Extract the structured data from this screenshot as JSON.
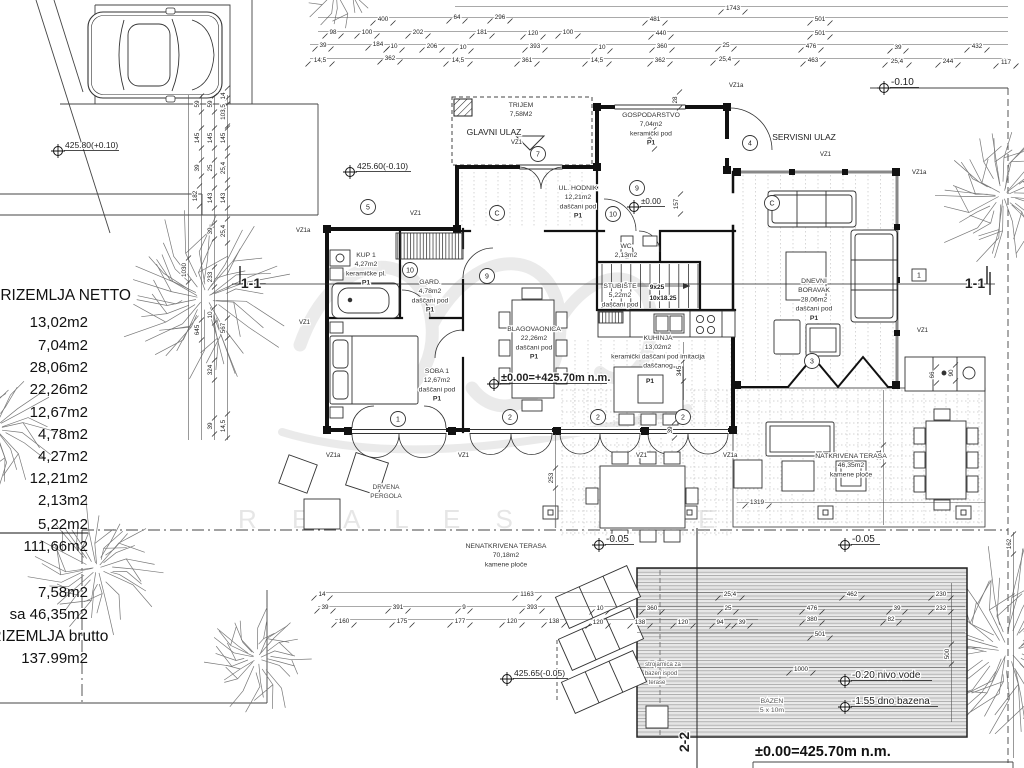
{
  "plan": {
    "watermark_text": "R E A L   E S T A T E",
    "datum_note": "±0.00=425.70m n.m.",
    "area_table": {
      "title": "PRIZEMLJA NETTO",
      "items": [
        "13,02m2",
        "7,04m2",
        "28,06m2",
        "22,26m2",
        "12,67m2",
        "4,78m2",
        "4,27m2",
        "12,21m2",
        "2,13m2",
        "5,22m2",
        "111,66m2"
      ],
      "extra_items": [
        "7,58m2",
        "sa  46,35m2"
      ],
      "total_label": "PRIZEMLJA brutto",
      "total_value": "137.99m2"
    },
    "rooms": [
      {
        "n": "trijem",
        "x": 521,
        "y": 107,
        "lines": [
          "TRIJEM",
          "7,58M2"
        ]
      },
      {
        "n": "gospodarstvo",
        "x": 651,
        "y": 117,
        "lines": [
          "GOSPODARSTVO",
          "7,04m2",
          "keramički pod",
          "P1"
        ]
      },
      {
        "n": "ul-hodnik",
        "x": 578,
        "y": 190,
        "lines": [
          "UL. HODNIK",
          "12,21m2",
          "daščani pod",
          "P1"
        ]
      },
      {
        "n": "kup-1",
        "x": 366,
        "y": 257,
        "lines": [
          "KUP 1",
          "4,27m2",
          "keramičke pl.",
          "P1"
        ]
      },
      {
        "n": "gard",
        "x": 430,
        "y": 284,
        "lines": [
          "GARD.",
          "4,78m2",
          "daščani pod",
          "P1"
        ]
      },
      {
        "n": "wc",
        "x": 626,
        "y": 248,
        "lines": [
          "WC",
          "2,13m2"
        ]
      },
      {
        "n": "stubiste",
        "x": 620,
        "y": 288,
        "lines": [
          "STUBIŠTE",
          "5,22m2",
          "daščani pod"
        ]
      },
      {
        "n": "soba-1",
        "x": 437,
        "y": 373,
        "lines": [
          "SOBA 1",
          "12,67m2",
          "daščani pod",
          "P1"
        ]
      },
      {
        "n": "blagovaonica",
        "x": 534,
        "y": 331,
        "lines": [
          "BLAGOVAONICA",
          "22,26m2",
          "daščani pod",
          "P1"
        ]
      },
      {
        "n": "kuhinja",
        "x": 658,
        "y": 340,
        "lines": [
          "KUHINJA",
          "13,02m2",
          "keramički daščani pod  imitacija",
          "daščanog"
        ]
      },
      {
        "n": "dnevni-boravak",
        "x": 814,
        "y": 283,
        "lines": [
          "DNEVNI",
          "BORAVAK",
          "28,06m2",
          "daščani pod",
          "P1"
        ]
      },
      {
        "n": "natkrivena-terasa",
        "x": 851,
        "y": 458,
        "lines": [
          "NATKRIVENA TERASA",
          "46,35m2",
          "kamene ploče"
        ]
      },
      {
        "n": "nenatkrivena-terasa",
        "x": 506,
        "y": 548,
        "lines": [
          "NENATKRIVENA TERASA",
          "70,18m2",
          "kamene ploče"
        ]
      },
      {
        "n": "bazen",
        "x": 772,
        "y": 703,
        "lines": [
          "BAZEN",
          "5 x 10m"
        ],
        "c": "#555"
      }
    ],
    "labels": [
      {
        "t": "GLAVNI ULAZ",
        "x": 494,
        "y": 135,
        "s": 8.5
      },
      {
        "t": "SERVISNI ULAZ",
        "x": 804,
        "y": 140,
        "s": 8.5
      },
      {
        "t": "DRVENA",
        "x": 386,
        "y": 489,
        "s": 6.5,
        "c": "#444"
      },
      {
        "t": "PERGOLA",
        "x": 386,
        "y": 498,
        "s": 6.5,
        "c": "#444"
      },
      {
        "t": "strojarnica za",
        "x": 663,
        "y": 666,
        "s": 6,
        "c": "#555"
      },
      {
        "t": "bazen ispod",
        "x": 661,
        "y": 675,
        "s": 6,
        "c": "#555"
      },
      {
        "t": "terase",
        "x": 657,
        "y": 684,
        "s": 6,
        "c": "#555"
      },
      {
        "t": "9x25",
        "x": 657,
        "y": 289,
        "s": 6.5,
        "b": true
      },
      {
        "t": "10x18.25",
        "x": 663,
        "y": 300,
        "s": 6.5,
        "b": true
      },
      {
        "t": "P1",
        "x": 650,
        "y": 383,
        "s": 6.5,
        "b": true
      }
    ],
    "vz_labels": [
      {
        "t": "VZ1",
        "x": 410,
        "y": 215
      },
      {
        "t": "VZ1a",
        "x": 296,
        "y": 232
      },
      {
        "t": "VZ1",
        "x": 299,
        "y": 324
      },
      {
        "t": "VZ1",
        "x": 511,
        "y": 144
      },
      {
        "t": "VZ1a",
        "x": 729,
        "y": 87
      },
      {
        "t": "VZ1",
        "x": 820,
        "y": 156
      },
      {
        "t": "VZ1a",
        "x": 912,
        "y": 174
      },
      {
        "t": "VZ1",
        "x": 917,
        "y": 332
      },
      {
        "t": "VZ1a",
        "x": 326,
        "y": 457
      },
      {
        "t": "VZ1",
        "x": 458,
        "y": 457
      },
      {
        "t": "VZ1",
        "x": 636,
        "y": 457
      },
      {
        "t": "VZ1a",
        "x": 723,
        "y": 457
      }
    ],
    "sections": [
      {
        "t": "1-1",
        "x": 251,
        "y": 288,
        "s": 14
      },
      {
        "t": "1-1",
        "x": 975,
        "y": 288,
        "s": 14
      },
      {
        "t": "2-2",
        "x": 689,
        "y": 742,
        "s": 14,
        "rot": -90
      }
    ],
    "markers_circled": [
      [
        "5",
        368,
        207
      ],
      [
        "7",
        538,
        154
      ],
      [
        "4",
        750,
        143
      ],
      [
        "C",
        497,
        213
      ],
      [
        "C",
        772,
        203
      ],
      [
        "10",
        410,
        270
      ],
      [
        "9",
        487,
        276
      ],
      [
        "10",
        613,
        214
      ],
      [
        "9",
        637,
        188
      ],
      [
        "1",
        398,
        419
      ],
      [
        "2",
        510,
        417
      ],
      [
        "2",
        598,
        417
      ],
      [
        "2",
        683,
        417
      ],
      [
        "3",
        812,
        361
      ]
    ],
    "markers_boxed": [
      [
        "1",
        919,
        275
      ]
    ],
    "elevations": [
      {
        "t": "425.80(+0.10)",
        "sx": 58,
        "sy": 151,
        "s": 8.5,
        "w": 54
      },
      {
        "t": "425.60(-0.10)",
        "sx": 350,
        "sy": 172,
        "s": 8.5,
        "w": 54
      },
      {
        "t": "-0.10",
        "sx": 884,
        "sy": 88,
        "s": 10,
        "w": 28
      },
      {
        "t": "±0.00",
        "sx": 634,
        "sy": 207,
        "s": 8,
        "w": 24
      },
      {
        "t": "±0.00=+425.70m n.m.",
        "sx": 494,
        "sy": 384,
        "s": 11,
        "b": true,
        "w": 106
      },
      {
        "t": "-0.05",
        "sx": 599,
        "sy": 545,
        "s": 10,
        "w": 28
      },
      {
        "t": "-0.05",
        "sx": 845,
        "sy": 545,
        "s": 10,
        "w": 28
      },
      {
        "t": "425.65(-0.05)",
        "sx": 507,
        "sy": 679,
        "s": 8.5,
        "w": 54
      },
      {
        "t": "-0.20 nivo vode",
        "sx": 845,
        "sy": 681,
        "s": 10,
        "w": 80
      },
      {
        "t": "-1.55 dno bazena",
        "sx": 845,
        "sy": 707,
        "s": 10,
        "w": 86
      }
    ],
    "dims_h": [
      [
        "1743",
        733,
        6
      ],
      [
        "400",
        383,
        17
      ],
      [
        "64",
        457,
        15
      ],
      [
        "296",
        500,
        15
      ],
      [
        "481",
        655,
        17
      ],
      [
        "501",
        820,
        17
      ],
      [
        "98",
        333,
        30
      ],
      [
        "100",
        367,
        30
      ],
      [
        "202",
        418,
        30
      ],
      [
        "181",
        482,
        30
      ],
      [
        "120",
        533,
        31
      ],
      [
        "100",
        568,
        30
      ],
      [
        "440",
        661,
        31
      ],
      [
        "501",
        820,
        31
      ],
      [
        "39",
        323,
        43
      ],
      [
        "184",
        378,
        42
      ],
      [
        "10",
        394,
        44
      ],
      [
        "206",
        432,
        44
      ],
      [
        "10",
        463,
        45
      ],
      [
        "393",
        535,
        44
      ],
      [
        "10",
        602,
        45
      ],
      [
        "360",
        662,
        44
      ],
      [
        "25",
        726,
        43
      ],
      [
        "476",
        811,
        44
      ],
      [
        "39",
        898,
        45
      ],
      [
        "432",
        977,
        44
      ],
      [
        "14,5",
        320,
        58
      ],
      [
        "362",
        390,
        56
      ],
      [
        "14,5",
        458,
        58
      ],
      [
        "361",
        527,
        58
      ],
      [
        "14,5",
        597,
        58
      ],
      [
        "362",
        660,
        58
      ],
      [
        "25,4",
        725,
        57
      ],
      [
        "463",
        813,
        58
      ],
      [
        "25,4",
        897,
        59
      ],
      [
        "244",
        948,
        59
      ],
      [
        "117",
        1006,
        60
      ],
      [
        "14",
        322,
        592
      ],
      [
        "1163",
        527,
        592
      ],
      [
        "25,4",
        730,
        592
      ],
      [
        "462",
        852,
        592
      ],
      [
        "230",
        941,
        592
      ],
      [
        "39",
        325,
        605
      ],
      [
        "391",
        398,
        605
      ],
      [
        "9",
        464,
        605
      ],
      [
        "393",
        532,
        605
      ],
      [
        "10",
        600,
        606
      ],
      [
        "360",
        652,
        606
      ],
      [
        "25",
        728,
        606
      ],
      [
        "476",
        812,
        606
      ],
      [
        "39",
        897,
        606
      ],
      [
        "232",
        941,
        606
      ],
      [
        "160",
        344,
        619
      ],
      [
        "175",
        402,
        619
      ],
      [
        "177",
        460,
        619
      ],
      [
        "120",
        512,
        619
      ],
      [
        "138",
        554,
        619
      ],
      [
        "120",
        598,
        620
      ],
      [
        "138",
        640,
        620
      ],
      [
        "120",
        683,
        620
      ],
      [
        "94",
        720,
        620
      ],
      [
        "39",
        742,
        620
      ],
      [
        "380",
        812,
        617
      ],
      [
        "82",
        891,
        617
      ],
      [
        "501",
        820,
        632
      ],
      [
        "1000",
        801,
        667
      ],
      [
        "1319",
        757,
        500
      ]
    ],
    "dims_v": [
      [
        "1030",
        186,
        270
      ],
      [
        "59",
        199,
        104
      ],
      [
        "145",
        199,
        138
      ],
      [
        "39",
        199,
        168
      ],
      [
        "182",
        197,
        196
      ],
      [
        "645",
        199,
        330
      ],
      [
        "59",
        212,
        104
      ],
      [
        "145",
        212,
        138
      ],
      [
        "25",
        212,
        168
      ],
      [
        "143",
        212,
        198
      ],
      [
        "39",
        212,
        231
      ],
      [
        "233",
        212,
        277
      ],
      [
        "10",
        212,
        315
      ],
      [
        "324",
        212,
        370
      ],
      [
        "39",
        212,
        426
      ],
      [
        "14",
        225,
        96
      ],
      [
        "103,5",
        225,
        112
      ],
      [
        "145",
        225,
        138
      ],
      [
        "25,4",
        225,
        168
      ],
      [
        "143",
        225,
        198
      ],
      [
        "25,4",
        225,
        231
      ],
      [
        "567",
        225,
        328
      ],
      [
        "14,5",
        225,
        426
      ],
      [
        "28",
        677,
        100
      ],
      [
        "194",
        652,
        139
      ],
      [
        "157",
        678,
        204
      ],
      [
        "345",
        681,
        371
      ],
      [
        "39",
        672,
        430
      ],
      [
        "253",
        553,
        478
      ],
      [
        "381",
        881,
        455
      ],
      [
        "66",
        934,
        375
      ],
      [
        "90",
        953,
        373
      ],
      [
        "162",
        1011,
        544
      ],
      [
        "500",
        949,
        654
      ]
    ],
    "site": {
      "trees": [
        {
          "x": 205,
          "y": 298,
          "r": 92
        },
        {
          "x": 97,
          "y": 568,
          "r": 70
        },
        {
          "x": 257,
          "y": 658,
          "r": 60
        },
        {
          "x": 1003,
          "y": 195,
          "r": 78
        },
        {
          "x": 1008,
          "y": 650,
          "r": 112
        },
        {
          "x": -5,
          "y": 428,
          "r": 64
        },
        {
          "x": 336,
          "y": -10,
          "r": 42
        }
      ]
    }
  }
}
